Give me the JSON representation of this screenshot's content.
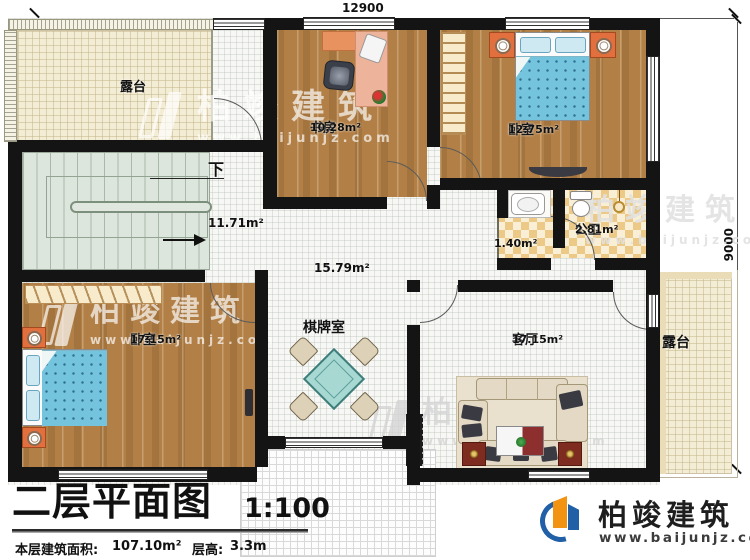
{
  "dimensions": {
    "top": "12900",
    "right": "9000"
  },
  "rooms": {
    "terrace_tl": {
      "label": "露台"
    },
    "study": {
      "label": "书房",
      "area": "10.28m²"
    },
    "bedroom_tr": {
      "label": "卧室",
      "area": "12.75m²"
    },
    "bath": {
      "label": "公卫",
      "area": "2.81m²",
      "vanity_area": "1.40m²"
    },
    "stairs": {
      "down": "下",
      "area": "11.71m²"
    },
    "hall": {
      "area": "15.79m²",
      "game_label": "棋牌室"
    },
    "bedroom_bl": {
      "label": "卧室",
      "area": "17.15m²"
    },
    "living": {
      "label": "客厅",
      "area": "17.15m²"
    },
    "terrace_r": {
      "label": "露台"
    }
  },
  "titleblock": {
    "title": "二层平面图",
    "scale": "1:100",
    "area_label": "本层建筑面积:",
    "area_value": "107.10m²",
    "height_label": "层高:",
    "height_value": "3.3m"
  },
  "brand": {
    "name": "柏竣建筑",
    "url": "www.baijunjz.com"
  },
  "colors": {
    "wall": "#141414",
    "wood": "#b28047",
    "terrace": "#f4edd6",
    "tile": "#ecc987",
    "bed": "#74c4de",
    "logo_blue": "#2160a6",
    "logo_orange": "#f29412"
  }
}
